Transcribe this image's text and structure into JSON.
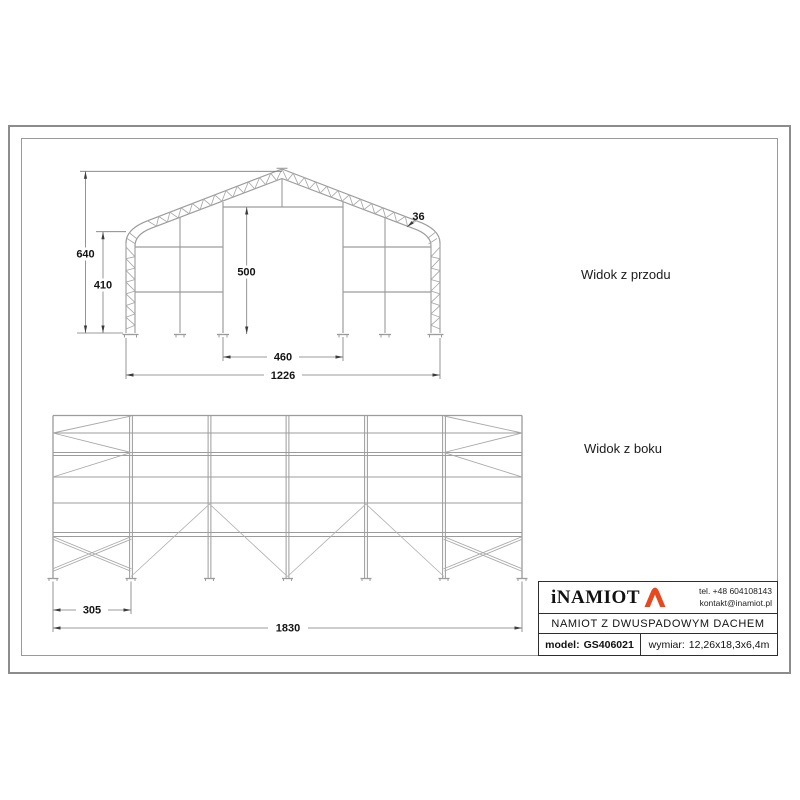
{
  "front_view": {
    "label": "Widok z przodu",
    "dimensions": {
      "total_height": "640",
      "wall_height": "410",
      "door_height": "500",
      "door_width": "460",
      "total_width": "1226",
      "truss_depth": "36"
    }
  },
  "side_view": {
    "label": "Widok z boku",
    "dimensions": {
      "end_bay_width": "305",
      "total_length": "1830"
    }
  },
  "title_block": {
    "logo_text": "iNAMIOT",
    "contact": {
      "phone": "tel. +48 604108143",
      "email": "kontakt@inamiot.pl"
    },
    "product_name": "NAMIOT Z DWUSPADOWYM DACHEM",
    "model": {
      "label": "model:",
      "value": "GS406021"
    },
    "size": {
      "label": "wymiar:",
      "value": "12,26x18,3x6,4m"
    },
    "accent_color": "#e8481d"
  }
}
